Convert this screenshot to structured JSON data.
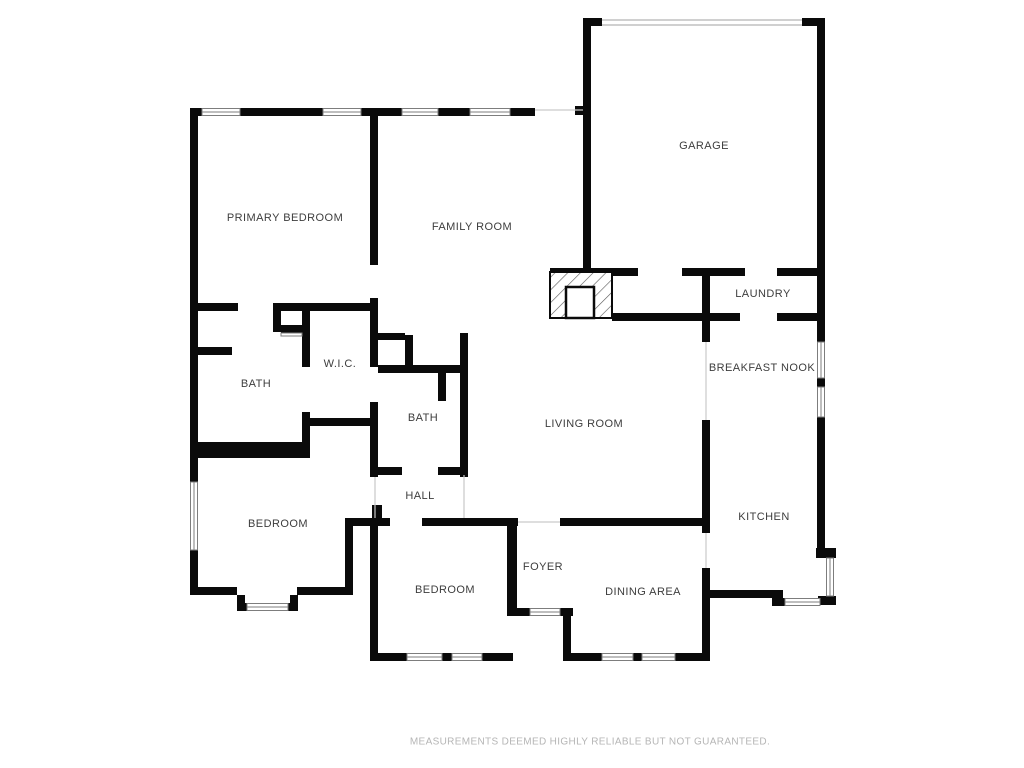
{
  "colors": {
    "wall": "#0a0a0a",
    "label_text": "#3d3d3d",
    "window_outline": "#7d7d7d",
    "opening_hairline": "#b5b5b5",
    "disclaimer_text": "#b5b5b5"
  },
  "rooms": [
    {
      "id": "garage",
      "name": "GARAGE"
    },
    {
      "id": "primary-bedroom",
      "name": "PRIMARY BEDROOM"
    },
    {
      "id": "family-room",
      "name": "FAMILY ROOM"
    },
    {
      "id": "laundry",
      "name": "LAUNDRY"
    },
    {
      "id": "breakfast-nook",
      "name": "BREAKFAST NOOK"
    },
    {
      "id": "wic",
      "name": "W.I.C."
    },
    {
      "id": "primary-bath",
      "name": "BATH"
    },
    {
      "id": "hall-bath",
      "name": "BATH"
    },
    {
      "id": "living-room",
      "name": "LIVING ROOM"
    },
    {
      "id": "hall",
      "name": "HALL"
    },
    {
      "id": "kitchen",
      "name": "KITCHEN"
    },
    {
      "id": "bedroom-left",
      "name": "BEDROOM"
    },
    {
      "id": "foyer",
      "name": "FOYER"
    },
    {
      "id": "bedroom-center",
      "name": "BEDROOM"
    },
    {
      "id": "dining-area",
      "name": "DINING AREA"
    }
  ],
  "footer": {
    "disclaimer": "MEASUREMENTS DEEMED HIGHLY RELIABLE BUT NOT GUARANTEED."
  }
}
